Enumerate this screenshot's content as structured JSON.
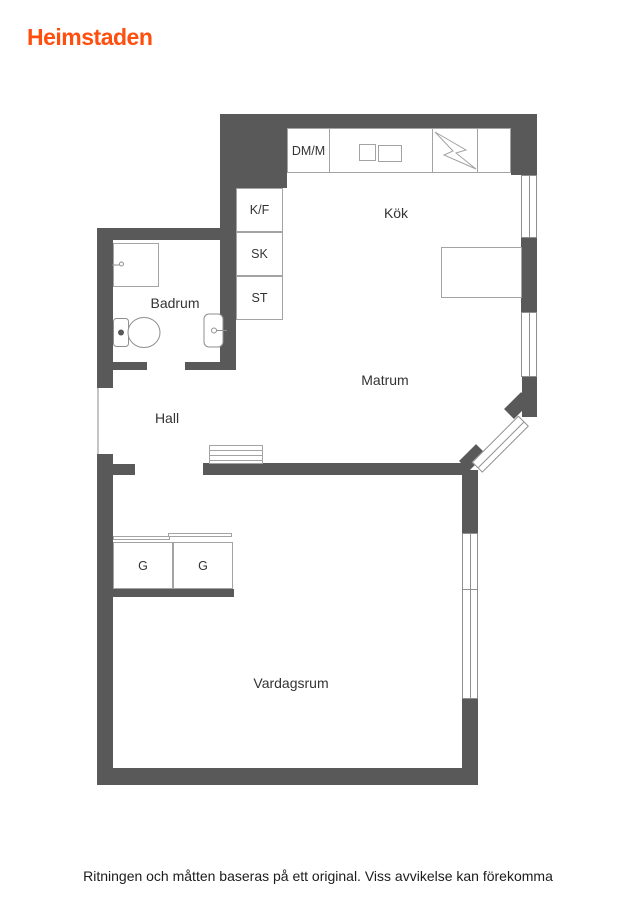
{
  "brand": {
    "logo_text": "Heimstaden",
    "logo_color": "#ff4e0e"
  },
  "floorplan": {
    "wall_color": "#595959",
    "rooms": {
      "kok": "Kök",
      "matrum": "Matrum",
      "badrum": "Badrum",
      "hall": "Hall",
      "vardagsrum": "Vardagsrum"
    },
    "units": {
      "dmm": "DM/M",
      "kf": "K/F",
      "sk": "SK",
      "st": "ST",
      "g1": "G",
      "g2": "G"
    }
  },
  "footer": {
    "disclaimer": "Ritningen och måtten baseras på ett original. Viss avvikelse kan förekomma"
  }
}
